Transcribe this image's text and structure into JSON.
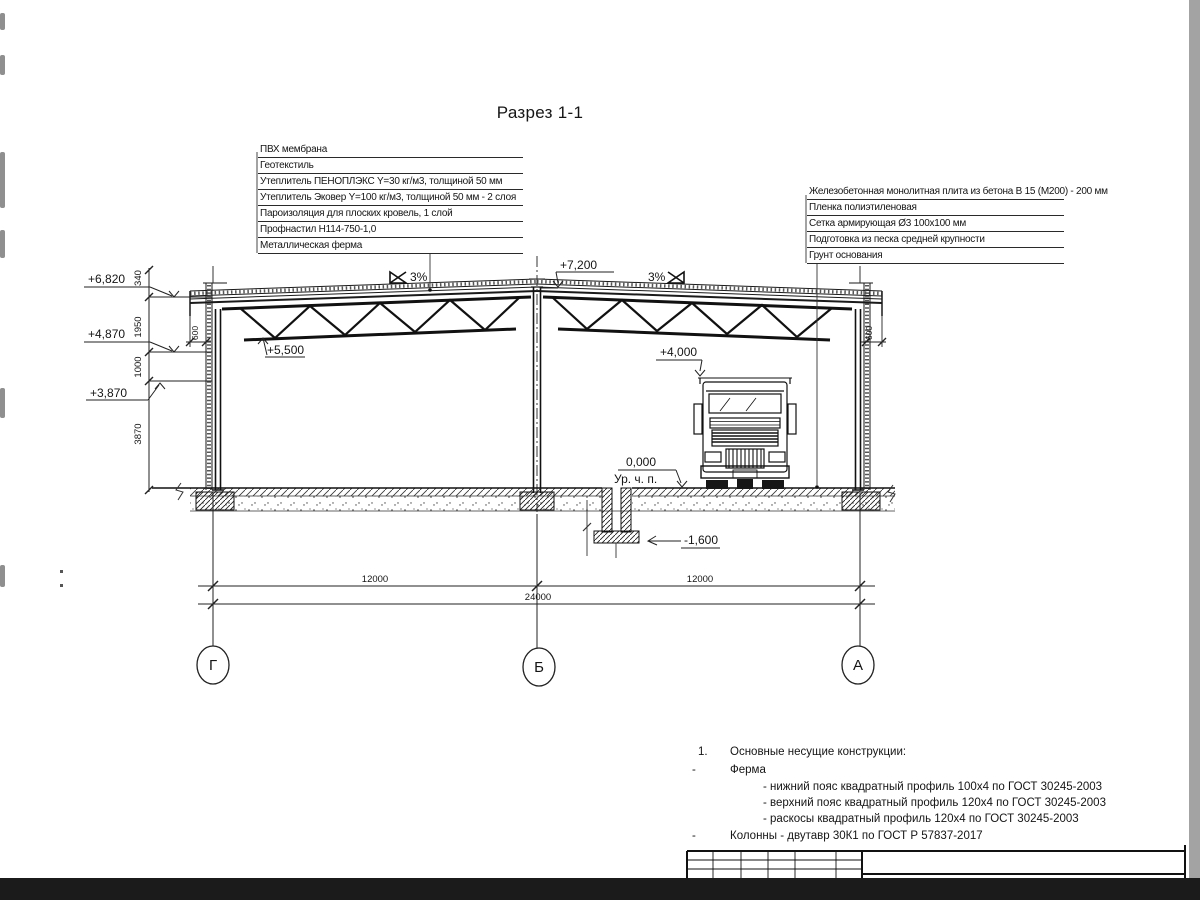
{
  "title": "Разрез 1-1",
  "roof_callouts": [
    "ПВХ мембрана",
    "Геотекстиль",
    "Утеплитель ПЕНОПЛЭКС Y=30 кг/м3, толщиной 50 мм",
    "Утеплитель Эковер Y=100 кг/м3, толщиной 50 мм - 2 слоя",
    "Пароизоляция для плоских кровель, 1 слой",
    "Профнастил Н114-750-1,0",
    "Металлическая ферма"
  ],
  "floor_callouts": [
    "Железобетонная монолитная плита из бетона В 15 (М200) - 200 мм",
    "Пленка полиэтиленовая",
    "Сетка армирующая Ø3 100х100 мм",
    "Подготовка из песка средней крупности",
    "Грунт основания"
  ],
  "elevations": {
    "e7160_dim_top": "340",
    "e6820": "+6,820",
    "e4870": "+4,870",
    "e3870": "+3,870",
    "e7200": "+7,200",
    "e5500": "+5,500",
    "e4000": "+4,000",
    "e0": "0,000",
    "floor_label": "Ур. ч. п.",
    "em1600": "-1,600"
  },
  "slopes": {
    "left": "3%",
    "right": "3%"
  },
  "dims": {
    "v340": "340",
    "v1950": "1950",
    "v1000": "1000",
    "v3870": "3870",
    "overhang_left": "600",
    "overhang_right": "600",
    "span1": "12000",
    "span2": "12000",
    "total": "24000"
  },
  "axes": [
    "Г",
    "Б",
    "А"
  ],
  "notes": {
    "item_no": "1.",
    "heading": "Основные несущие конструкции:",
    "dash1": "-",
    "truss_label": "Ферма",
    "truss_items": [
      "- нижний пояс квадратный профиль 100х4 по ГОСТ 30245-2003",
      "- верхний пояс квадратный профиль 120х4 по ГОСТ 30245-2003",
      "- раскосы квадратный профиль 120х4 по ГОСТ 30245-2003"
    ],
    "dash2": "-",
    "columns_item": "Колонны - двутавр 30К1 по ГОСТ Р 57837-2017"
  }
}
